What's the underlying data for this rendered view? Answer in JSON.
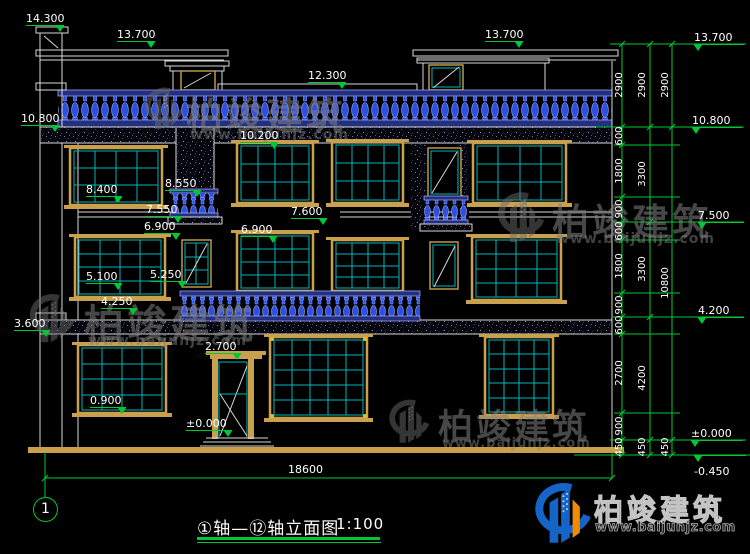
{
  "markers": [
    {
      "text": "14.300"
    },
    {
      "text": "13.700"
    },
    {
      "text": "12.300"
    },
    {
      "text": "13.700"
    },
    {
      "text": "13.700"
    },
    {
      "text": "10.800"
    },
    {
      "text": "10.200"
    },
    {
      "text": "10.800"
    },
    {
      "text": "8.400"
    },
    {
      "text": "8.550"
    },
    {
      "text": "7.550"
    },
    {
      "text": "7.600"
    },
    {
      "text": "7.500"
    },
    {
      "text": "6.900"
    },
    {
      "text": "6.900"
    },
    {
      "text": "5.100"
    },
    {
      "text": "5.250"
    },
    {
      "text": "4.250"
    },
    {
      "text": "4.200"
    },
    {
      "text": "3.600"
    },
    {
      "text": "2.700"
    },
    {
      "text": "0.900"
    },
    {
      "text": "±0.000"
    },
    {
      "text": "±0.000"
    },
    {
      "text": "-0.450"
    }
  ],
  "dims": {
    "col1": [
      "2900",
      "600",
      "1800",
      "900",
      "600",
      "1800",
      "900",
      "600",
      "2700",
      "900",
      "450"
    ],
    "col2": [
      "2900",
      "3300",
      "3300",
      "4200",
      "450"
    ],
    "col3": [
      "2900",
      "10800",
      "450"
    ],
    "total": "18600"
  },
  "axis": {
    "bubble": "1"
  },
  "titleblock": {
    "title": "①轴—⑫轴立面图",
    "scale": "1:100"
  },
  "watermark": {
    "brand": "柏竣建筑",
    "url": "www.baijunjz.com"
  },
  "colors": {
    "dim_green": "#00c832",
    "line_white": "#d9d9d9",
    "frame_tan": "#c9a14e",
    "glass_cyan": "#00b8b8",
    "baluster_blue": "#3050e8",
    "brand_blue": "#1565c8",
    "brand_orange": "#f08a00"
  }
}
